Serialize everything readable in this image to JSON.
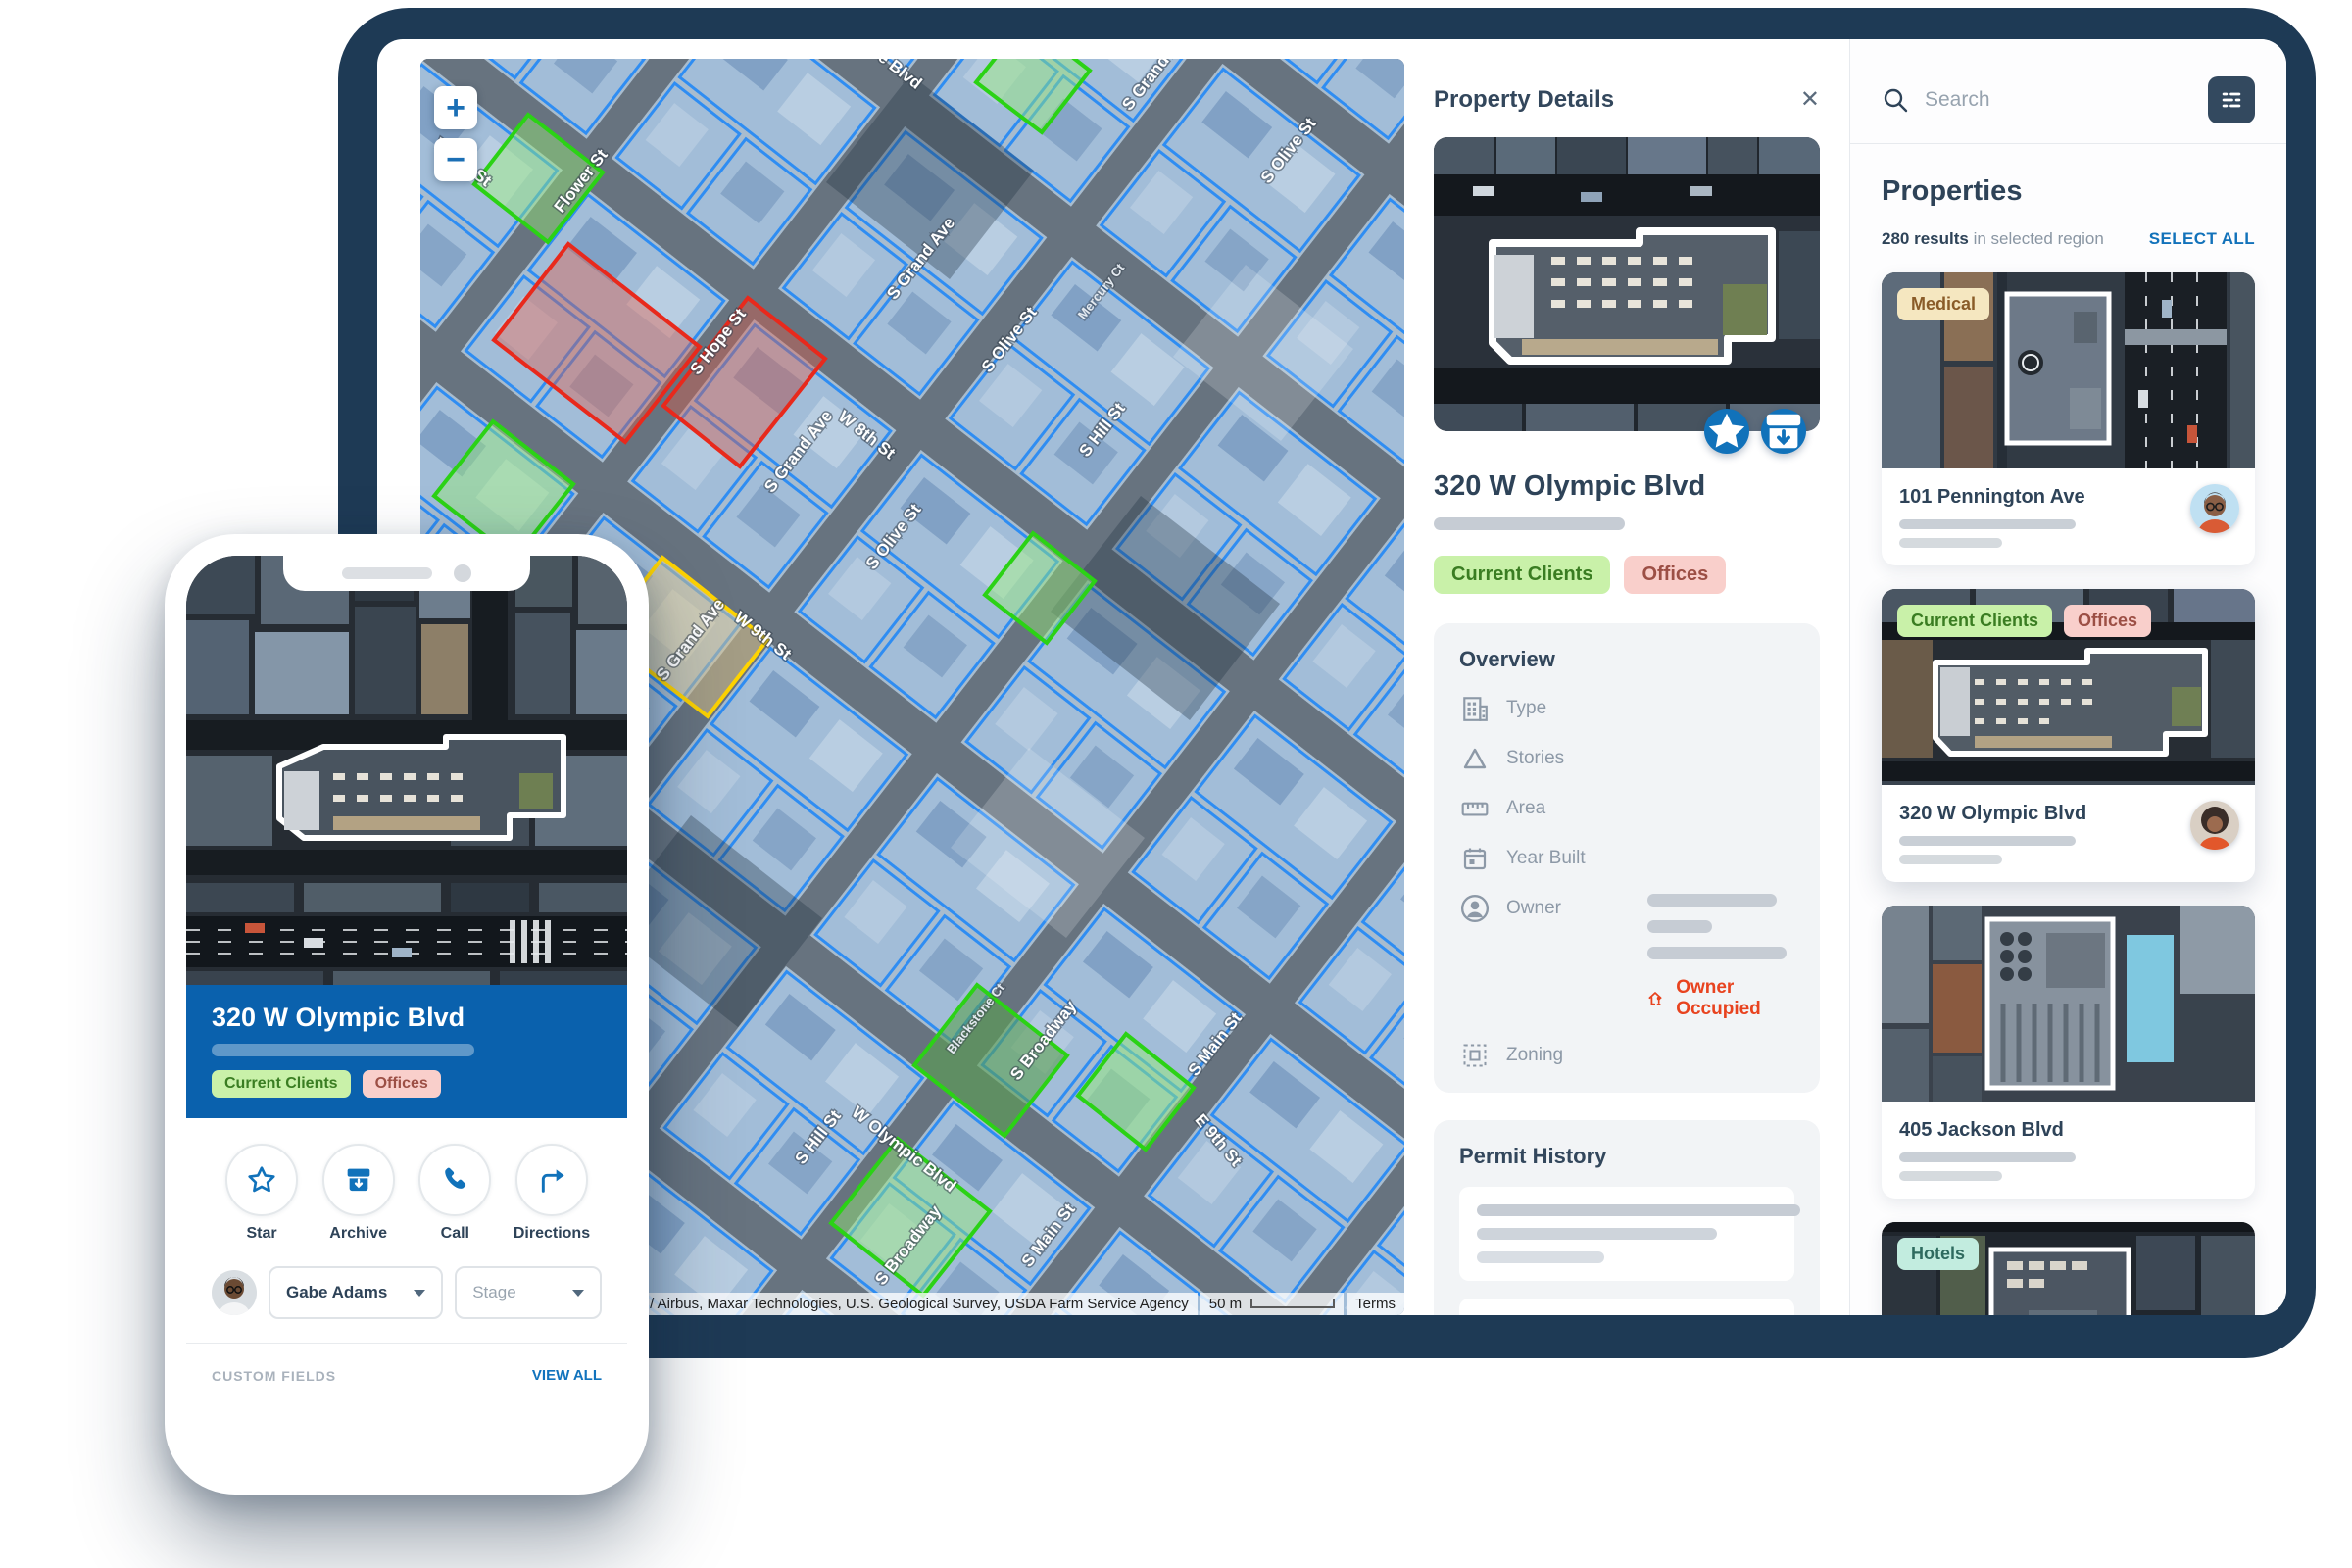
{
  "colors": {
    "backdrop_navy": "#1e3a55",
    "accent_blue": "#1172ba",
    "heading_navy": "#2e4358",
    "owner_occupied_red": "#e8431f",
    "banner_blue": "#0a61ad",
    "tag_green_bg": "#c9f1a9",
    "tag_green_text": "#3a7d22",
    "tag_pink_bg": "#f9cfcb",
    "tag_pink_text": "#9c4f45",
    "tag_cream_bg": "#f5e7c0",
    "tag_cream_text": "#8a5c28",
    "tag_mint_bg": "#c2ecdf",
    "tag_mint_text": "#2f6b5f",
    "parcel_blue": "#2f8df2",
    "parcel_green": "#2bd215",
    "parcel_red": "#e8291c",
    "parcel_yellow": "#ffd400"
  },
  "map": {
    "zoom_in": "+",
    "zoom_out": "−",
    "attribution": "©2021 , CNES / Airbus, Maxar Technologies, U.S. Geological Survey, USDA Farm Service Agency",
    "scale": "50 m",
    "terms": "Terms",
    "street_labels": [
      "Flower St",
      "W 8th St",
      "e Blvd",
      "S Grand Ave",
      "S Hope St",
      "S Grand Ave",
      "S Olive St",
      "Mercury Ct",
      "S Hill St",
      "S Grand Ave",
      "W 8th St",
      "S Olive St",
      "W 9th St",
      "S Grand Ave",
      "S Olive St",
      "S Hill St",
      "W Olympic Blvd",
      "S Broadway",
      "S Broadway",
      "S Main St",
      "S Main St",
      "E 9th St",
      "Blackstone Ct"
    ]
  },
  "details": {
    "title": "Property Details",
    "close": "✕",
    "address": "320 W Olympic Blvd",
    "tags": [
      "Current Clients",
      "Offices"
    ],
    "overview": {
      "title": "Overview",
      "labels": [
        "Type",
        "Stories",
        "Area",
        "Year Built",
        "Owner",
        "Zoning"
      ],
      "owner_occupied": "Owner Occupied"
    },
    "permits": {
      "title": "Permit History"
    }
  },
  "sidebar": {
    "search_placeholder": "Search",
    "title": "Properties",
    "results_bold": "280 results",
    "results_rest": " in selected region",
    "select_all": "SELECT ALL",
    "cards": [
      {
        "tag": "Medical",
        "address": "101 Pennington Ave"
      },
      {
        "tags": [
          "Current Clients",
          "Offices"
        ],
        "address": "320 W Olympic Blvd"
      },
      {
        "address": "405 Jackson Blvd"
      },
      {
        "tag": "Hotels"
      }
    ]
  },
  "phone": {
    "address": "320 W Olympic Blvd",
    "tags": [
      "Current Clients",
      "Offices"
    ],
    "actions": [
      "Star",
      "Archive",
      "Call",
      "Directions"
    ],
    "assignee": "Gabe Adams",
    "stage": "Stage",
    "custom_fields": "CUSTOM FIELDS",
    "view_all": "VIEW ALL",
    "contacts": "CONTACTS",
    "edit": "EDIT"
  }
}
